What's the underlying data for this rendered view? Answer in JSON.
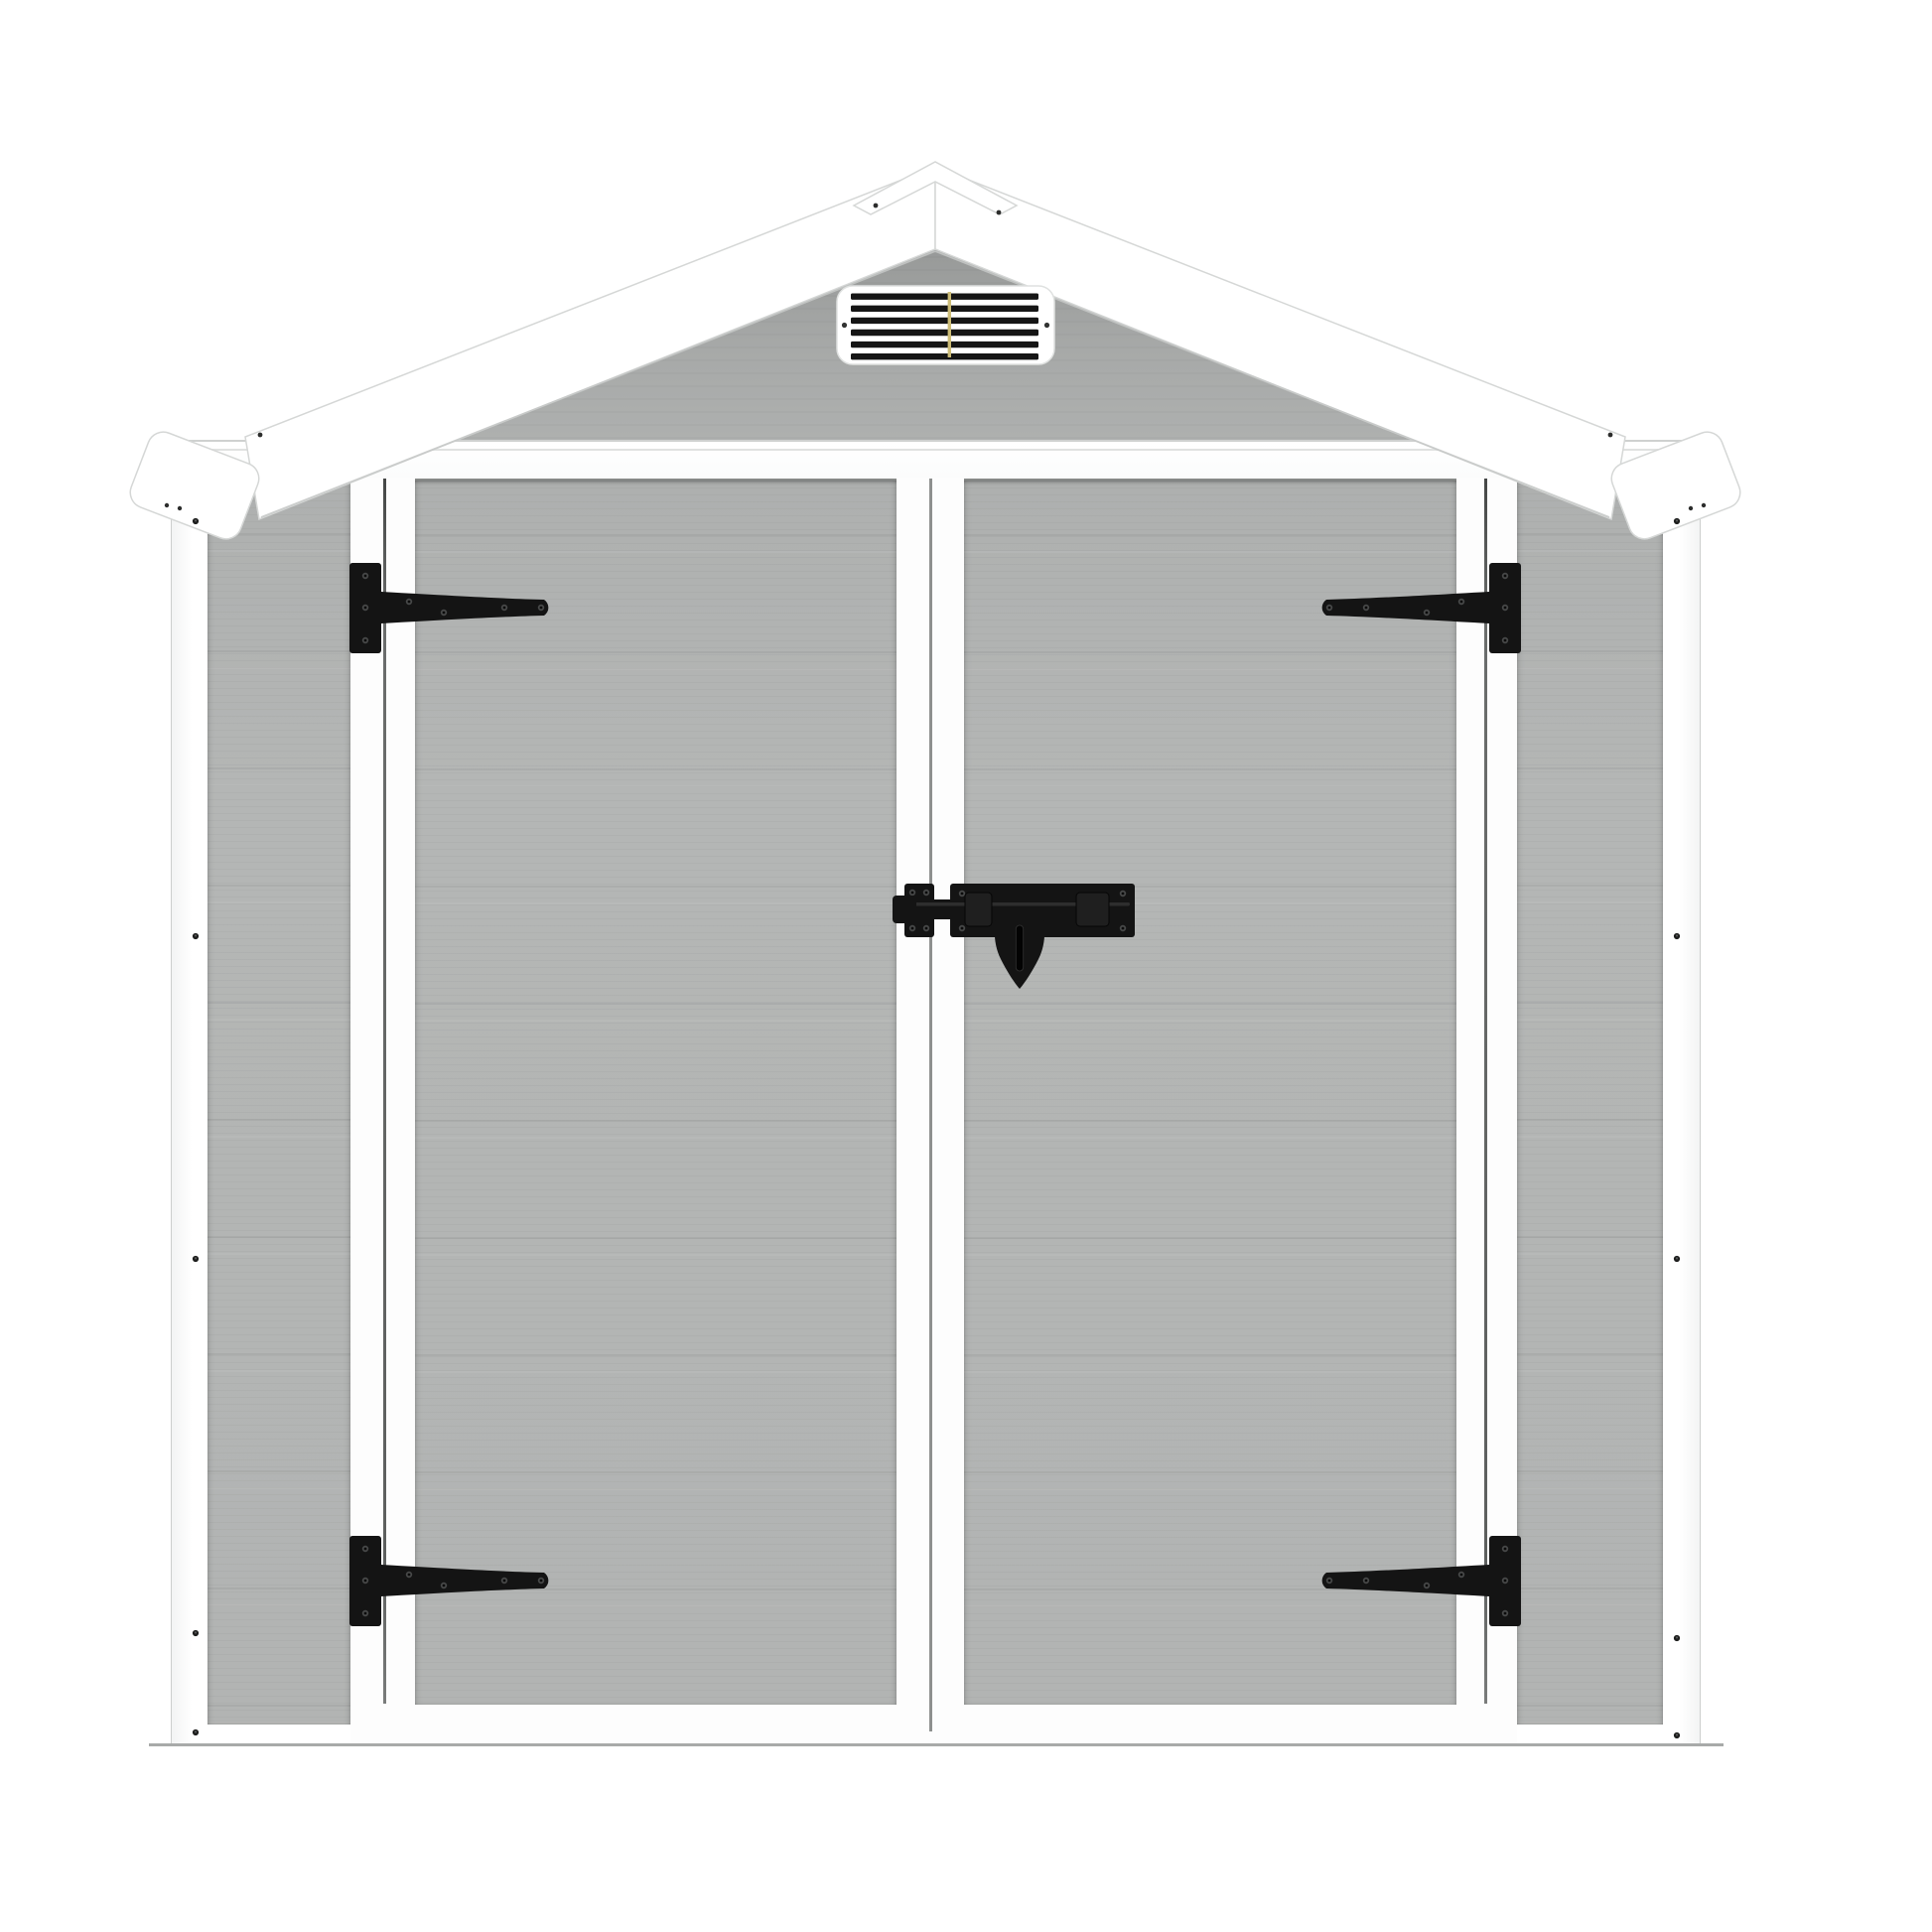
{
  "scene": {
    "subject": "gray-garden-storage-shed-front-view",
    "background": "#ffffff"
  },
  "palette": {
    "bg": "#ffffff",
    "panel": "#b2b4b3",
    "gable_top": "#999b9a",
    "gable_bottom": "#b1b3b2",
    "trim_white": "#fdfdfd",
    "outline": "#d5d7d6",
    "seam": "#8e908f",
    "gap_dark": "#4a4c4b",
    "hardware": "#141414",
    "screw_highlight": "#474848",
    "vent_slat": "#151515",
    "vent_accent": "#ccbc77",
    "floor": "#a8aaa9"
  },
  "vent": {
    "louvers": 6
  },
  "hardware": {
    "hinges": 4,
    "latch_bolts": 1
  }
}
